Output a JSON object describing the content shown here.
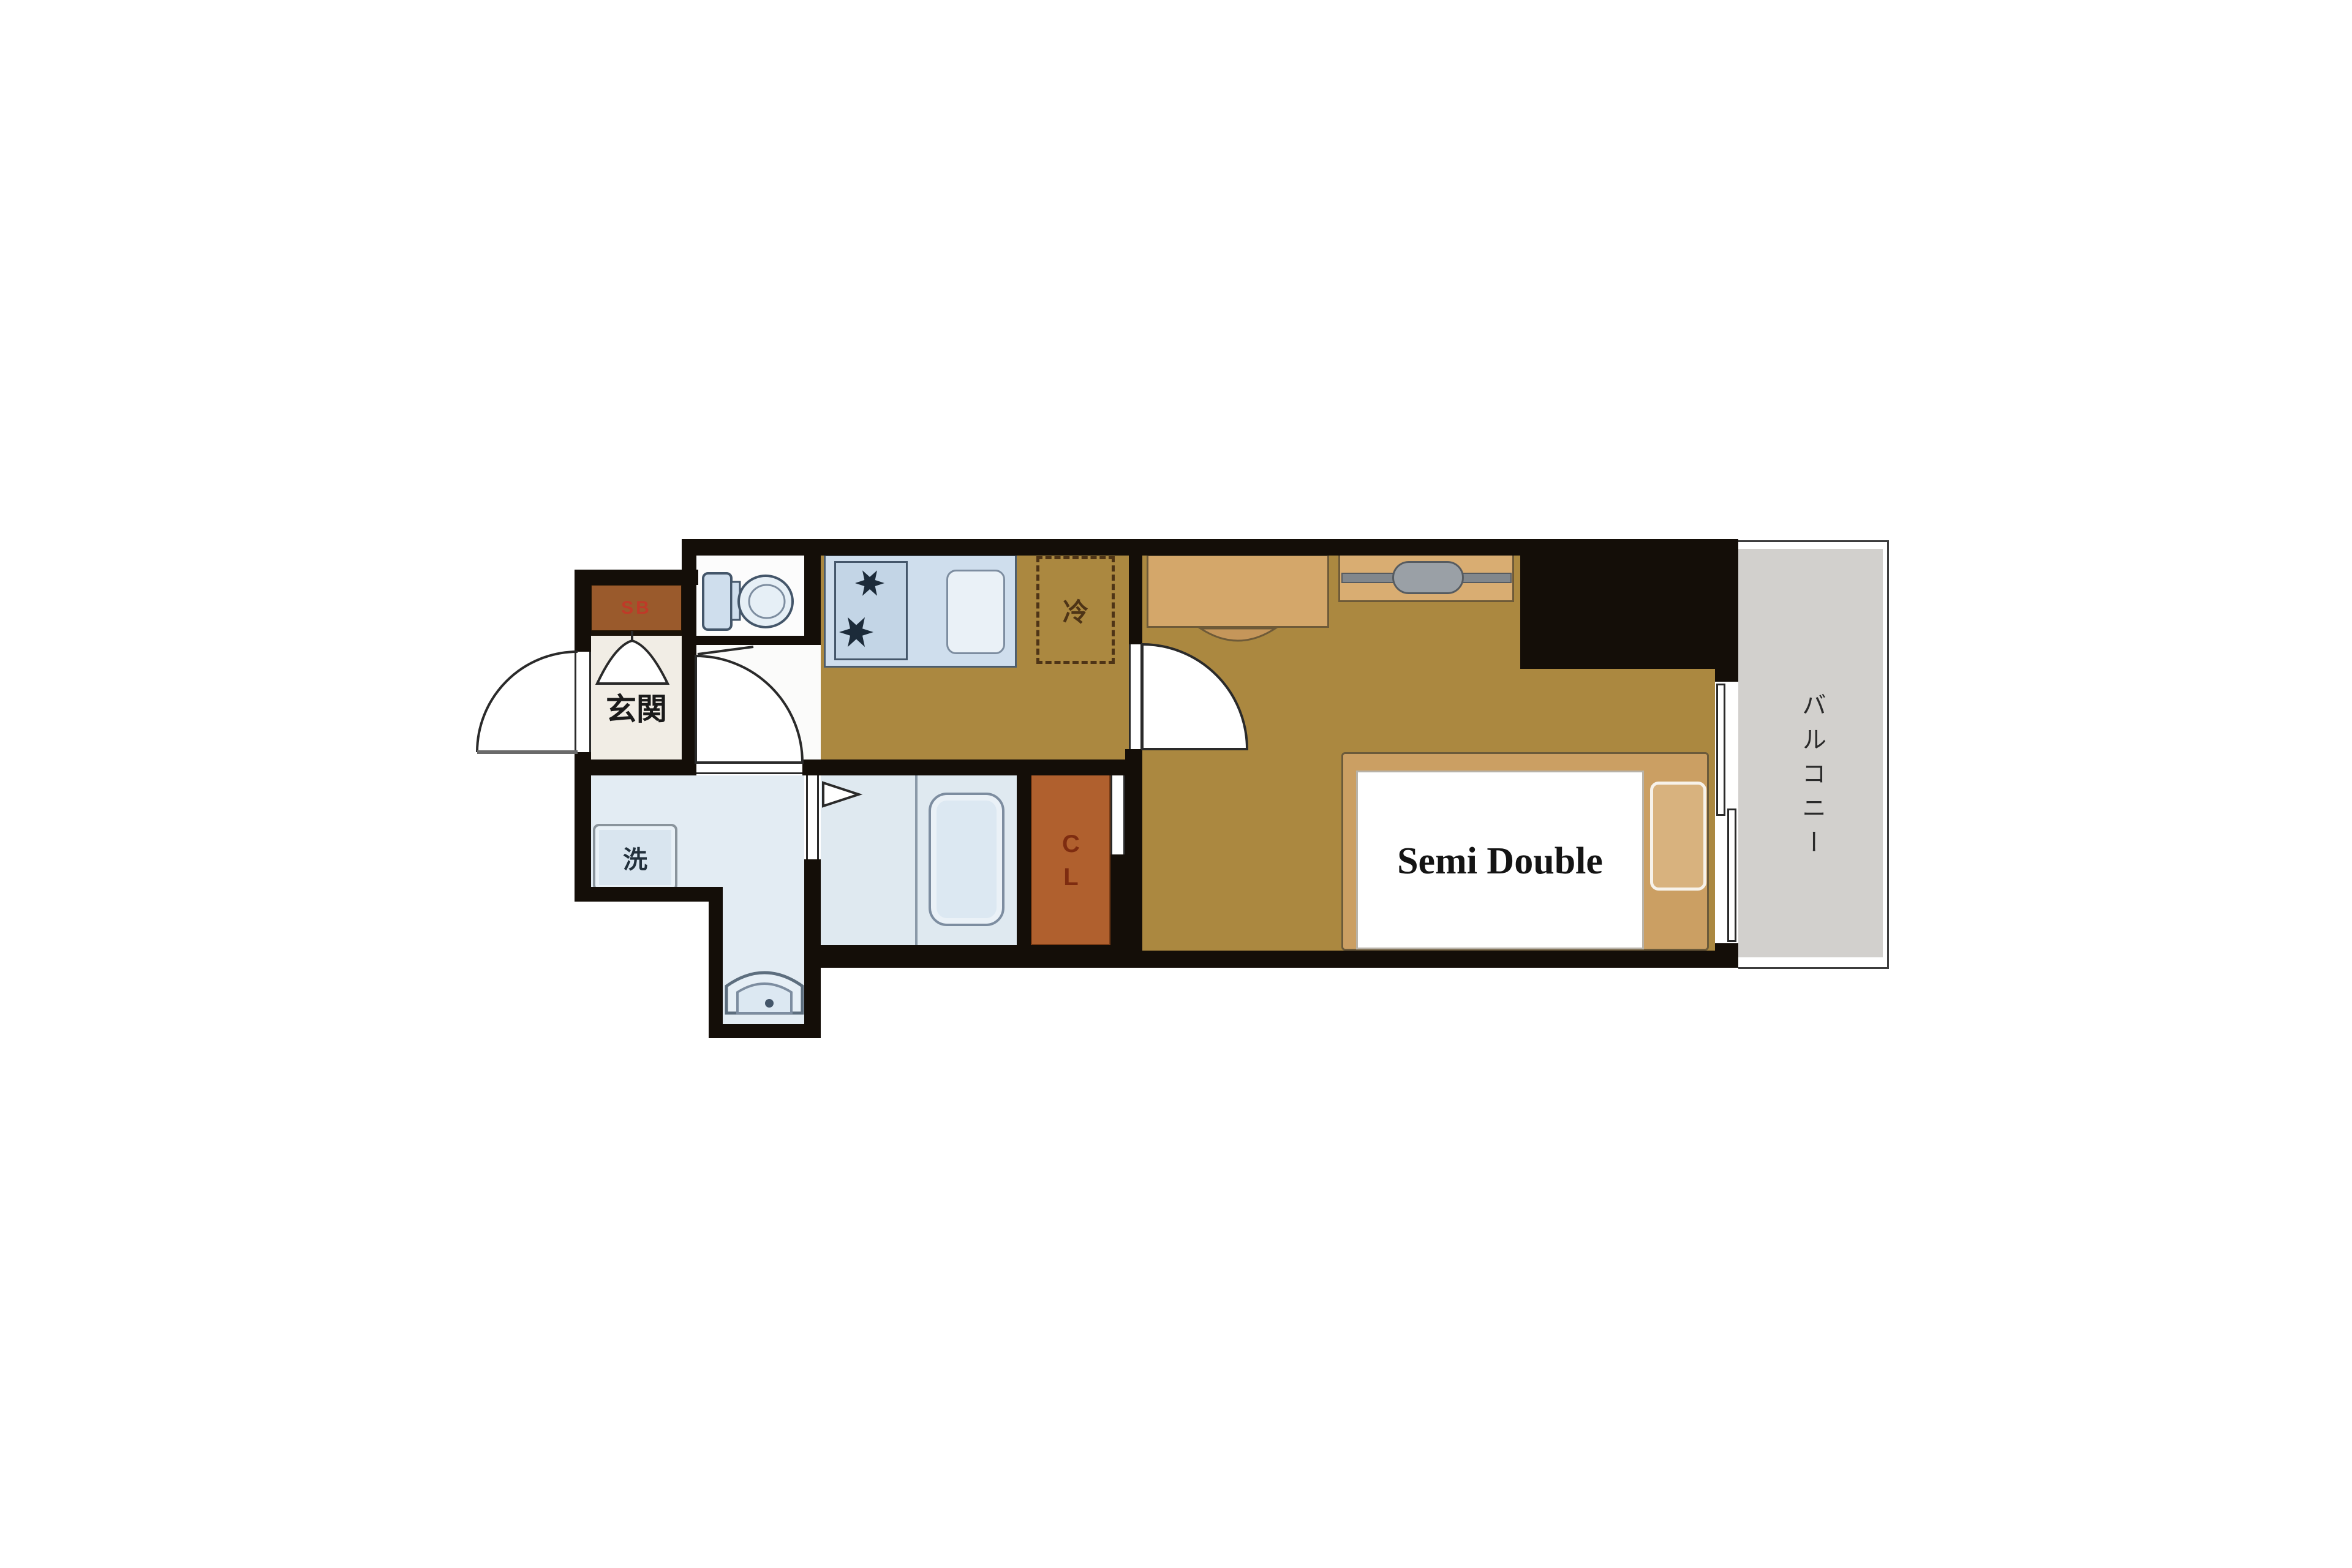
{
  "title": "apartment floor plan",
  "labels": {
    "entrance": "玄関",
    "shoe_box": "SB",
    "washer": "洗",
    "refrigerator": "冷",
    "closet": "CL",
    "balcony": "バルコニー",
    "bed": "Semi Double"
  },
  "icons": [
    "toilet-icon",
    "stove-burner-icon",
    "kitchen-sink-icon",
    "bathtub-icon",
    "washbasin-icon",
    "washing-machine-icon",
    "hanger-rod-icon",
    "door-swing-arc-icon",
    "sliding-window-icon",
    "folding-door-triangle-icon"
  ],
  "colors": {
    "wall": "#140e08",
    "wood_floor": "#ab8840",
    "furniture_tan": "#d4a76a",
    "bed_frame": "#cb9f63",
    "pillow": "#d8b27e",
    "closet": "#b0602e",
    "closet_text": "#7e2c10",
    "shoe_box": "#9a5a2c",
    "shoe_box_text": "#bf3a28",
    "fixture_blue": "#cfdeed",
    "wet_room_floor": "#e3ecf3",
    "entrance_floor": "#f1ede5",
    "balcony_gray": "#d2d0cd",
    "fridge_dash": "#4e3416"
  }
}
